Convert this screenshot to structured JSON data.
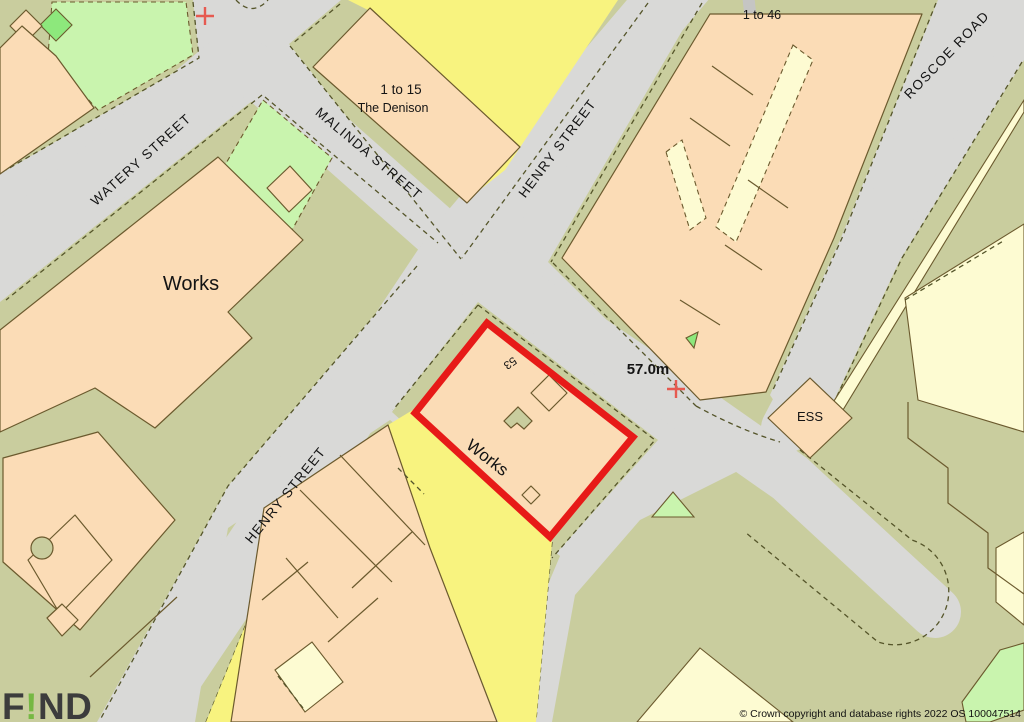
{
  "map": {
    "attribution": "© Crown copyright and database rights 2022 OS 100047514",
    "logo": {
      "f": "F",
      "bang": "!",
      "nd": "ND"
    },
    "spot_height": "57.0m",
    "streets": [
      {
        "name": "watery-street",
        "label": "WATERY STREET"
      },
      {
        "name": "malinda-street",
        "label": "MALINDA STREET"
      },
      {
        "name": "henry-street-north",
        "label": "HENRY STREET"
      },
      {
        "name": "henry-street-south",
        "label": "HENRY STREET"
      },
      {
        "name": "roscoe-road",
        "label": "ROSCOE ROAD"
      }
    ],
    "labels": {
      "works_west": "Works",
      "works_plot": "Works",
      "plot_number": "53",
      "denison_range": "1 to 15",
      "denison_name": "The Denison",
      "flats_range": "1 to 46",
      "ess": "ESS"
    },
    "palette": {
      "road": "#d9d9d7",
      "verge": "#c9cd9e",
      "building": "#fbdcb6",
      "yellow_land": "#f8f37f",
      "pale_green": "#c9f4ae",
      "bright_green": "#8de87c",
      "cream": "#fdfbd2",
      "outline": "#6b5a2e",
      "dash_line": "#55552a",
      "plot_red": "#e71a18",
      "cross_red": "#e65a50",
      "logo_green": "#76b843",
      "text": "#141414"
    }
  }
}
